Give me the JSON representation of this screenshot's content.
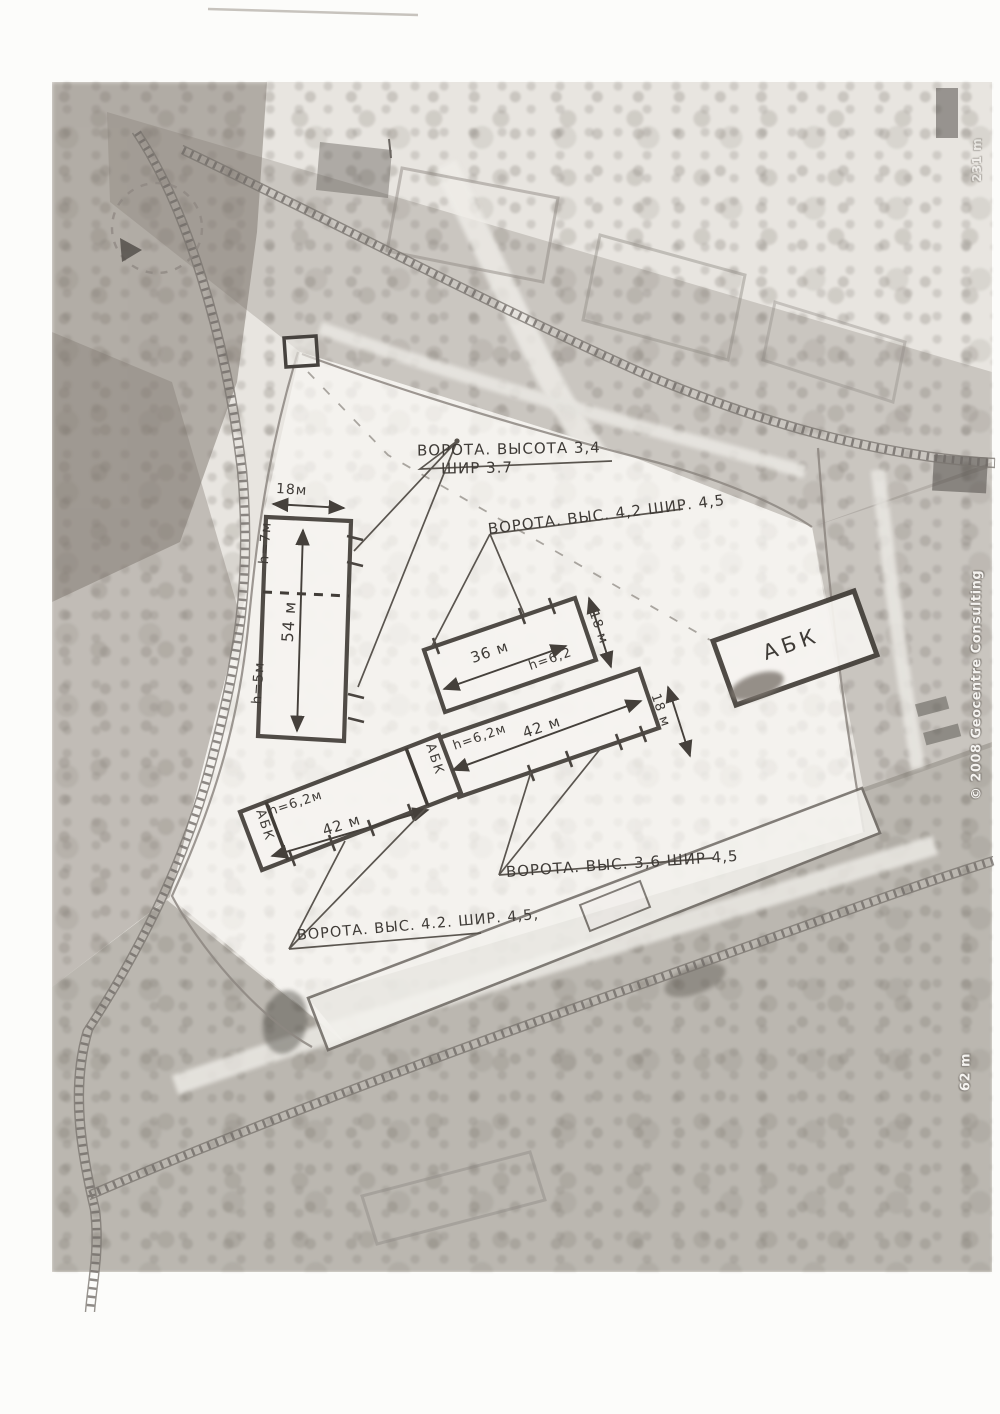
{
  "annotations": {
    "gate_top_1": "ВОРОТА. ВЫСОТА 3,4",
    "gate_top_2": "ШИР 3.7",
    "gate_mid": "ВОРОТА. ВЫС. 4,2 ШИР. 4,5",
    "gate_right": "ВОРОТА. ВЫС. 3,6 ШИР 4,5",
    "gate_bottom": "ВОРОТА. ВЫС. 4.2. ШИР. 4,5,"
  },
  "buildings": {
    "left": {
      "width": "18м",
      "length": "54 м",
      "height_upper": "h=7м",
      "height_lower": "h=5м"
    },
    "mid36": {
      "length": "36 м",
      "height": "h=6,2",
      "width": "18 м"
    },
    "mid42": {
      "length": "42 м",
      "height": "h=6,2м",
      "width": "18 м"
    },
    "low42": {
      "length": "42 м",
      "height": "h=6,2м",
      "abk_end": "АБК",
      "abk_link": "АБК"
    },
    "abk": {
      "label": "АБК"
    }
  },
  "watermarks": {
    "copyright": "© 2008 Geocentre Consulting",
    "scale": "62 m",
    "edge_fragment": "231 m"
  }
}
